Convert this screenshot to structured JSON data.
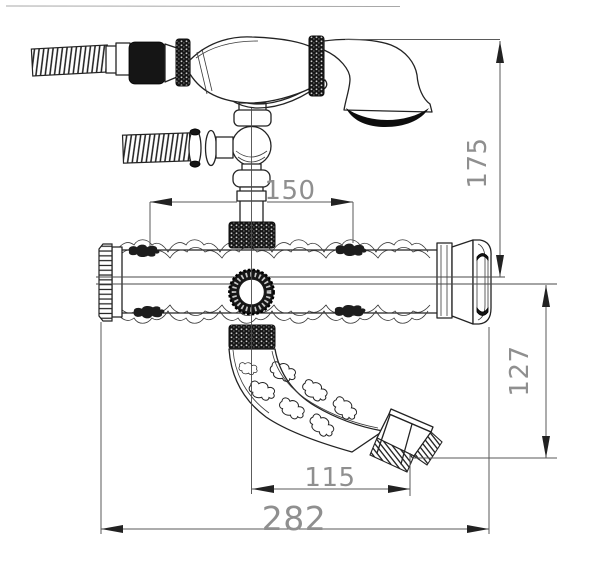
{
  "dimensions": {
    "inlet_spacing": "150",
    "overall_height": "175",
    "spout_drop": "127",
    "spout_reach": "115",
    "overall_width": "282"
  },
  "colors": {
    "line": "#232323",
    "dimension_line": "#5a5a5a",
    "dimension_text": "#8f8f8f",
    "black_parts": "#151515",
    "background": "#ffffff"
  }
}
